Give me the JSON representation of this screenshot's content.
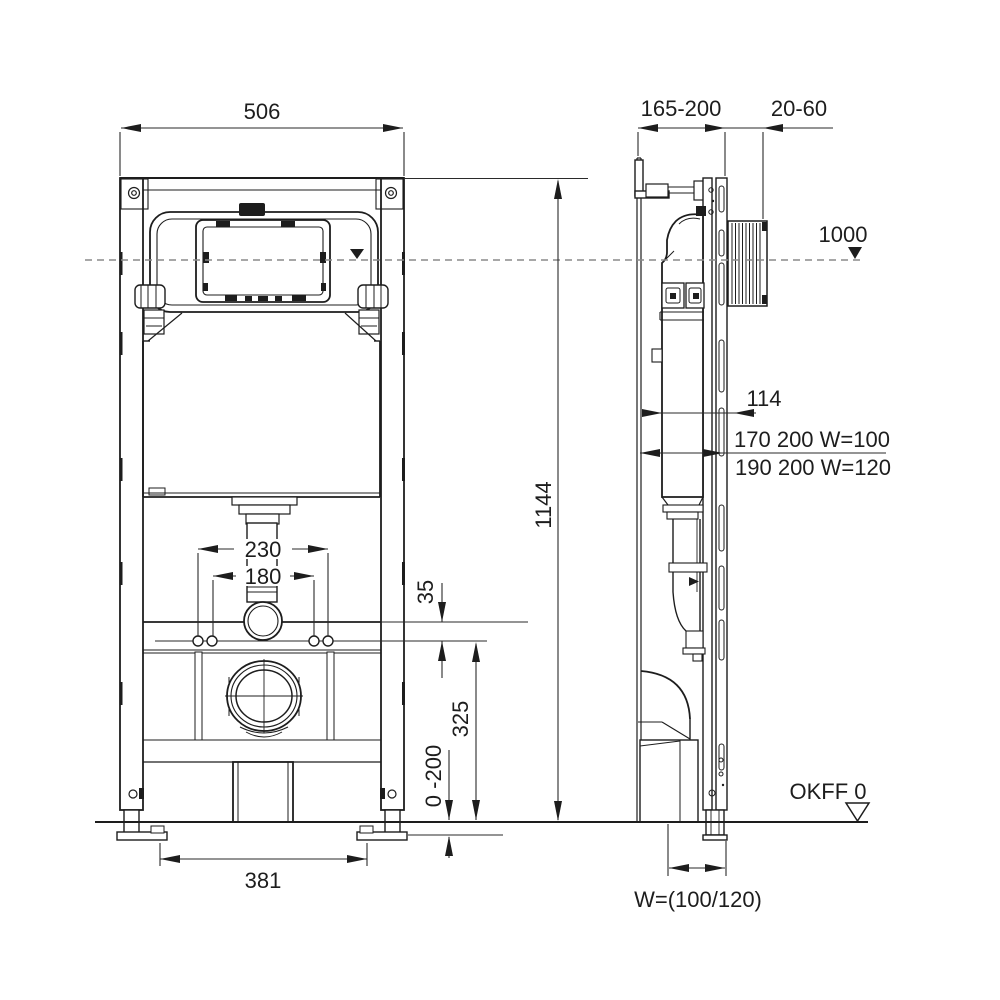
{
  "drawing_type": "installation-frame-technical-drawing",
  "colors": {
    "line": "#1d1d1d",
    "dim": "#2a2a2a",
    "centerline": "#8a8a8a",
    "background": "#ffffff"
  },
  "front": {
    "width": "506",
    "height": "1144",
    "spacing_outer": "230",
    "spacing_inner": "180",
    "offset": "35",
    "drain_height": "325",
    "foot_adjust": "0 -200",
    "foot_spacing": "381"
  },
  "side": {
    "depth": "165-200",
    "wall_gap": "20-60",
    "actuation_height": "1000",
    "depth_inner": "114",
    "spec_line_1": "170 200 W=100",
    "spec_line_2": "190 200 W=120",
    "floor_ref": "OKFF 0",
    "outlet_width": "W=(100/120)"
  }
}
